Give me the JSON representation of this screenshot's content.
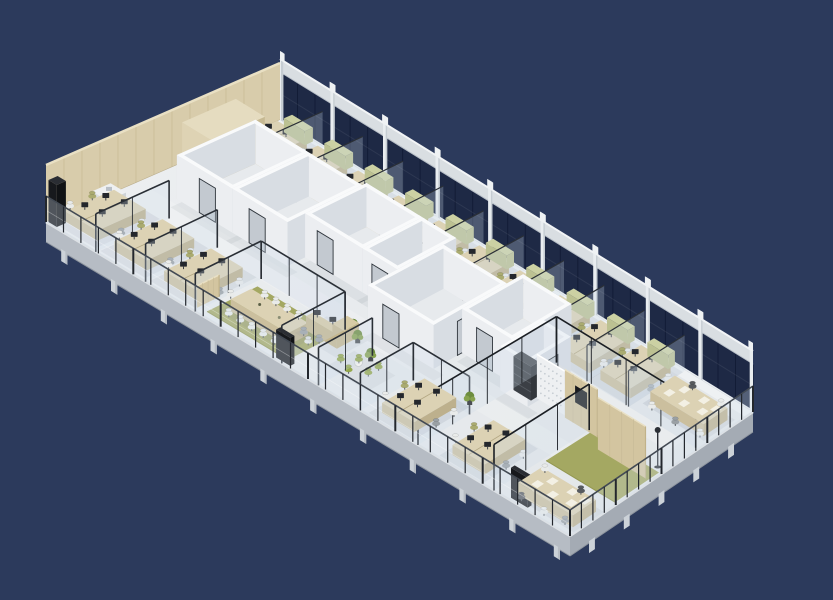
{
  "scene": {
    "label": "isometric-cutaway-3d-render-of-open-plan-office-floor",
    "canvas": {
      "w": 833,
      "h": 600
    },
    "background": "#2c3a5c",
    "quad": {
      "W": [
        46,
        222
      ],
      "N": [
        280,
        120
      ],
      "E": [
        753,
        412
      ],
      "S": [
        570,
        536
      ]
    },
    "heights": {
      "glass": 48,
      "parapet": 13,
      "column": 69,
      "capBase": 60,
      "wood": 57,
      "core": 44,
      "balustrade": 26,
      "slab": 20,
      "foot": 10,
      "desk": 10
    },
    "colors": {
      "bg": "#2c3a5c",
      "floorA": "#edeff1",
      "floorB": "#e2e6e9",
      "sillStrip": "#eef1f3",
      "slabFace": "#b6bcc4",
      "slabFaceDark": "#a4abb4",
      "slabLip": "#dde1e5",
      "foot": "#ccd2d8",
      "footShade": "#b6bcc3",
      "windowGlass": "#1e2945",
      "paneLine": "#121c36",
      "mullion": "#e9edf0",
      "mullionShade": "#c6cdd3",
      "parapet": "#d9dee2",
      "parapetTop": "#f2f4f6",
      "wood": "#d8ccab",
      "woodLine": "#c8bb97",
      "woodTop": "#e9e0c4",
      "woodLight": "#ded3b4",
      "wallSW": "#eceef1",
      "wallSE": "#d8dde3",
      "wallTop": "#f9fafb",
      "roomFloor": "#e7eaed",
      "glass": "rgba(205,220,232,0.28)",
      "glassFrame": "#2a2f36",
      "glassFrameDark": "#1b1f24",
      "doorLeaf": "#c3c9d0",
      "doorFrame": "#2e343b",
      "deskTop": "#dcd2b4",
      "deskSide": "#cbbf9e",
      "deskSideDark": "#bdb08d",
      "deskSeam": "#b3a783",
      "monitor": "#24272c",
      "chairWhite": "#e9ebea",
      "chairOlive": "#aaab70",
      "chairGrey": "#9aa0a4",
      "chairGreen": "#95a84c",
      "chairDark": "#565a5f",
      "rug": "#a4a862",
      "rugDark": "#939751",
      "counter": "#d7cba6",
      "counterSide": "#c5b78f",
      "screenWood": "#d3c5a0",
      "screenWoodSide": "#c1b289",
      "shelfDark": "#3b3f45",
      "perf": "#eef0f2",
      "perfDot": "#c7cdd3",
      "plant": "#6d8d3e",
      "plantLight": "#87a24f",
      "pot": "#4a4e53",
      "tv": "#17191d",
      "lamp": "#2c3036",
      "cabinet": "#eef0f1",
      "cabinetSide": "#dbdfe3",
      "oliveCab": "#ccd1a3",
      "oliveCabSide": "#bcc192",
      "paper": "#f3f0e4",
      "shadow": "rgba(75,85,105,0.10)",
      "shadowSoft": "rgba(75,85,105,0.07)",
      "balGlass": "rgba(212,226,238,0.30)",
      "balPost": "#23272d",
      "balRail": "#434a54"
    },
    "windowWall": {
      "bays": 9,
      "panesPerBay": 3
    },
    "woodWall": {
      "planks": 13
    },
    "corridorTints": [
      [
        0.02,
        0.295,
        0.97,
        0.395
      ],
      [
        0.02,
        0.615,
        0.97,
        0.7
      ]
    ],
    "coreRooms": [
      {
        "r": [
          0.065,
          0.42,
          0.175,
          0.76
        ],
        "doors": [
          {
            "side": "sw",
            "t": 0.55
          }
        ]
      },
      {
        "r": [
          0.175,
          0.42,
          0.285,
          0.76
        ],
        "doors": [
          {
            "side": "sw",
            "t": 0.45
          }
        ]
      },
      {
        "r": [
          0.285,
          0.5,
          0.4,
          0.78
        ],
        "doors": [
          {
            "side": "sw",
            "t": 0.35
          }
        ]
      },
      {
        "r": [
          0.4,
          0.5,
          0.47,
          0.78
        ],
        "doors": [
          {
            "side": "sw",
            "t": 0.5
          }
        ]
      },
      {
        "r": [
          0.47,
          0.36,
          0.6,
          0.72
        ],
        "doors": [
          {
            "side": "sw",
            "t": 0.35
          },
          {
            "side": "se",
            "t": 0.45
          }
        ]
      },
      {
        "r": [
          0.6,
          0.5,
          0.7,
          0.8
        ],
        "doors": [
          {
            "side": "sw",
            "t": 0.45
          }
        ]
      },
      {
        "r": [
          0.7,
          0.44,
          0.755,
          0.66
        ],
        "doors": [
          {
            "side": "se",
            "t": 0.5
          }
        ]
      }
    ],
    "glassWalls": [
      {
        "a": [
          0.095,
          0.0
        ],
        "b": [
          0.095,
          0.32
        ],
        "h": 38,
        "dark": false
      },
      {
        "a": [
          0.19,
          0.0
        ],
        "b": [
          0.19,
          0.32
        ],
        "h": 38,
        "dark": false
      },
      {
        "a": [
          0.285,
          0.0
        ],
        "b": [
          0.285,
          0.3
        ],
        "h": 38,
        "dark": false
      },
      {
        "a": [
          0.45,
          0.0
        ],
        "b": [
          0.45,
          0.3
        ],
        "h": 38,
        "dark": false
      },
      {
        "a": [
          0.285,
          0.3
        ],
        "b": [
          0.45,
          0.3
        ],
        "h": 38,
        "dark": false
      },
      {
        "a": [
          0.52,
          0.0
        ],
        "b": [
          0.52,
          0.26
        ],
        "h": 38,
        "dark": false
      },
      {
        "a": [
          0.6,
          0.0
        ],
        "b": [
          0.6,
          0.26
        ],
        "h": 38,
        "dark": false
      },
      {
        "a": [
          0.6,
          0.26
        ],
        "b": [
          0.71,
          0.26
        ],
        "h": 38,
        "dark": false
      },
      {
        "a": [
          0.71,
          0.0
        ],
        "b": [
          0.71,
          0.7
        ],
        "h": 46,
        "dark": true
      },
      {
        "a": [
          0.855,
          0.0
        ],
        "b": [
          0.855,
          0.5
        ],
        "h": 46,
        "dark": true
      },
      {
        "a": [
          0.71,
          0.7
        ],
        "b": [
          0.995,
          0.7
        ],
        "h": 46,
        "dark": true
      }
    ],
    "glassFins": {
      "v0": 0.7,
      "v1": 0.995,
      "h": 36,
      "u": [
        0.0925,
        0.1775,
        0.2625,
        0.3475,
        0.4325,
        0.5175,
        0.6025,
        0.6875,
        0.7725,
        0.8575
      ]
    },
    "deskClusters": [
      {
        "u": 0.05,
        "v": 0.845,
        "cab": true
      },
      {
        "u": 0.135,
        "v": 0.845,
        "cab": true
      },
      {
        "u": 0.22,
        "v": 0.845,
        "cab": true
      },
      {
        "u": 0.305,
        "v": 0.845,
        "cab": true
      },
      {
        "u": 0.39,
        "v": 0.845,
        "cab": true
      },
      {
        "u": 0.475,
        "v": 0.845,
        "cab": true
      },
      {
        "u": 0.56,
        "v": 0.845,
        "cab": true
      },
      {
        "u": 0.645,
        "v": 0.845,
        "cab": true
      },
      {
        "u": 0.73,
        "v": 0.845,
        "cab": true
      },
      {
        "u": 0.815,
        "v": 0.845,
        "cab": true
      },
      {
        "u": 0.045,
        "v": 0.155,
        "cab": false
      },
      {
        "u": 0.14,
        "v": 0.155,
        "cab": false
      },
      {
        "u": 0.235,
        "v": 0.155,
        "cab": false
      },
      {
        "u": 0.655,
        "v": 0.15,
        "cab": false
      },
      {
        "u": 0.79,
        "v": 0.15,
        "cab": false
      }
    ],
    "rugs": [
      {
        "r": [
          0.295,
          0.03,
          0.45,
          0.26
        ],
        "color": "rug"
      },
      {
        "r": [
          0.86,
          0.26,
          0.995,
          0.5
        ],
        "color": "rug"
      }
    ],
    "meetingTable": {
      "r": [
        0.315,
        0.09,
        0.425,
        0.185
      ],
      "chairsPerSide": 5
    },
    "bigTables": [
      {
        "r": [
          0.885,
          0.045,
          0.99,
          0.17
        ],
        "chairs": [
          [
            0.9,
            0.02,
            "chairDark"
          ],
          [
            0.945,
            0.015,
            "chairWhite"
          ],
          [
            0.98,
            0.03,
            "chairGrey"
          ],
          [
            0.88,
            0.2,
            "chairWhite"
          ],
          [
            0.95,
            0.2,
            "chairDark"
          ]
        ]
      },
      {
        "r": [
          0.875,
          0.77,
          0.985,
          0.9
        ],
        "chairs": [
          [
            0.89,
            0.74,
            "chairWhite"
          ],
          [
            0.94,
            0.735,
            "chairGrey"
          ],
          [
            0.985,
            0.75,
            "chairWhite"
          ],
          [
            0.9,
            0.93,
            "chairDark"
          ],
          [
            0.96,
            0.93,
            "chairWhite"
          ]
        ]
      }
    ],
    "counter": {
      "parts": [
        [
          0.415,
          0.2,
          0.475,
          0.235
        ],
        [
          0.452,
          0.235,
          0.475,
          0.305
        ]
      ],
      "monitors": [
        [
          0.432,
          0.212
        ],
        [
          0.458,
          0.222
        ]
      ],
      "chairs": [
        [
          0.425,
          0.165,
          "chairGrey"
        ],
        [
          0.452,
          0.172,
          "chairGrey"
        ]
      ]
    },
    "loungeChairs": [
      [
        0.505,
        0.145
      ],
      [
        0.53,
        0.12
      ],
      [
        0.553,
        0.158
      ],
      [
        0.522,
        0.19
      ],
      [
        0.553,
        0.208
      ]
    ],
    "loungeTable": [
      0.532,
      0.163
    ],
    "screens": [
      {
        "a": [
          0.75,
          0.5
        ],
        "b": [
          0.806,
          0.5
        ],
        "h": 44,
        "type": "perf",
        "tv": false
      },
      {
        "a": [
          0.81,
          0.49
        ],
        "b": [
          0.875,
          0.49
        ],
        "h": 48,
        "type": "wood",
        "tv": true
      },
      {
        "a": [
          0.895,
          0.44
        ],
        "b": [
          0.99,
          0.44
        ],
        "h": 52,
        "type": "wood",
        "tv": false
      },
      {
        "a": [
          0.28,
          0.02
        ],
        "b": [
          0.28,
          0.12
        ],
        "h": 22,
        "type": "wood",
        "tv": false
      }
    ],
    "shelf": {
      "r": [
        0.713,
        0.475,
        0.748,
        0.515
      ],
      "h": 34
    },
    "boothChairs": [
      [
        0.915,
        0.5,
        "chairOlive"
      ],
      [
        0.945,
        0.52,
        "chairOlive"
      ]
    ],
    "boothTable": [
      0.93,
      0.505
    ],
    "plants": [
      [
        0.485,
        0.275
      ],
      [
        0.528,
        0.232
      ],
      [
        0.462,
        0.31
      ],
      [
        0.695,
        0.3
      ]
    ],
    "lamp": [
      0.985,
      0.52
    ],
    "tvPanels": [
      {
        "r": [
          0.883,
          0.012,
          0.915,
          0.032
        ],
        "h": 30
      },
      {
        "r": [
          0.002,
          0.006,
          0.018,
          0.045
        ],
        "h": 42
      },
      {
        "r": [
          0.435,
          0.01,
          0.462,
          0.03
        ],
        "h": 28
      }
    ],
    "whiteCabinets": [
      {
        "r": [
          0.012,
          0.17,
          0.042,
          0.25
        ],
        "h": 17
      }
    ],
    "woodCabinet": {
      "r": [
        0.015,
        0.55,
        0.075,
        0.78
      ],
      "h": 48
    },
    "balustrade": {
      "postsSW": 30,
      "postsSE": 16
    },
    "feet": {
      "sw": [
        0.035,
        0.13,
        0.225,
        0.32,
        0.415,
        0.51,
        0.605,
        0.7,
        0.795,
        0.89,
        0.975
      ],
      "se": [
        0.12,
        0.31,
        0.5,
        0.69,
        0.88
      ]
    }
  }
}
